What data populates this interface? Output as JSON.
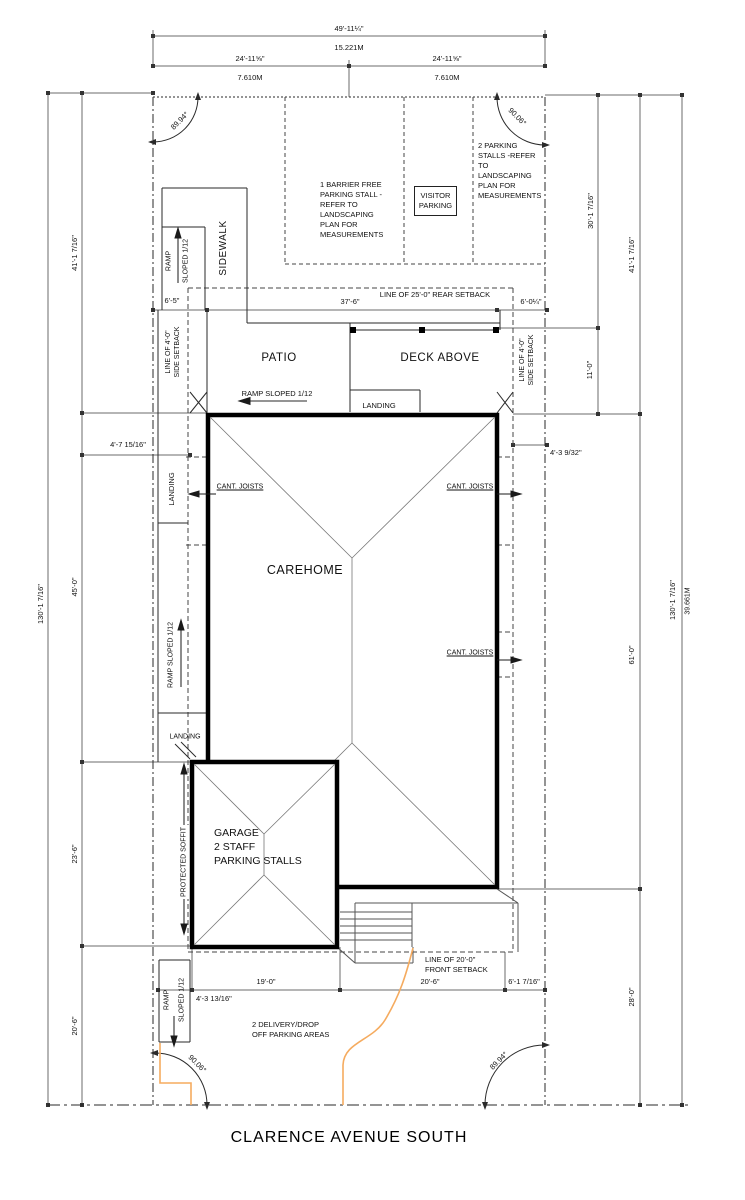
{
  "street_name": "CLARENCE AVENUE SOUTH",
  "colors": {
    "line": "#2a2a2a",
    "dim_line": "#6b6b6b",
    "building": "#000000",
    "driveway_accent": "#f5ab5f"
  },
  "angles": {
    "top_left": "89.94°",
    "top_right": "90.06°",
    "bottom_left": "90.06°",
    "bottom_right": "89.94°"
  },
  "dimensions": {
    "top": {
      "overall_ft": "49'-11¼\"",
      "overall_m": "15.221M",
      "half_left_ft": "24'-11⅝\"",
      "half_left_m": "7.610M",
      "half_right_ft": "24'-11⅝\"",
      "half_right_m": "7.610M"
    },
    "left": {
      "overall": "130'-1 7/16\"",
      "seg1": "41'-1 7/16\"",
      "seg2": "45'-0\"",
      "seg3": "23'-6\"",
      "seg4": "20'-6\"",
      "offset": "4'-7 15/16\""
    },
    "right": {
      "seg1": "30'-1 7/16\"",
      "seg2": "41'-1 7/16\"",
      "seg3": "11'-0\"",
      "seg4": "61'-0\"",
      "seg5": "28'-0\"",
      "overall_ft": "130'-1 7/16\"",
      "overall_m": "39.661M",
      "offset": "4'-3 9/32\""
    },
    "rear": {
      "left": "6'-5\"",
      "mid": "37'-6\"",
      "right": "6'-0¼\""
    },
    "bottom": {
      "seg1": "4'-3 13/16\"",
      "seg2": "19'-0\"",
      "seg3": "20'-6\"",
      "seg4": "6'-1 7/16\""
    }
  },
  "setbacks": {
    "rear": "LINE OF 25'-0\" REAR SETBACK",
    "side": "LINE OF 4'-0\"\nSIDE SETBACK",
    "front": "LINE OF 20'-0\"\nFRONT SETBACK"
  },
  "parking": {
    "barrier_free": "1 BARRIER FREE\nPARKING STALL -\nREFER TO\nLANDSCAPING\nPLAN FOR\nMEASUREMENTS",
    "visitor": "VISITOR\nPARKING",
    "two_stalls": "2 PARKING\nSTALLS -REFER\nTO\nLANDSCAPING\nPLAN FOR\nMEASUREMENTS",
    "delivery": "2 DELIVERY/DROP\nOFF PARKING AREAS"
  },
  "labels": {
    "sidewalk": "SIDEWALK",
    "ramp": "RAMP",
    "sloped": "SLOPED 1/12",
    "ramp_sloped": "RAMP SLOPED 1/12",
    "landing": "LANDING",
    "patio": "PATIO",
    "deck_above": "DECK ABOVE",
    "carehome": "CAREHOME",
    "cant_joists": "CANT. JOISTS",
    "protected_soffit": "PROTECTED SOFFIT",
    "garage": "GARAGE\n2 STAFF\nPARKING STALLS"
  }
}
